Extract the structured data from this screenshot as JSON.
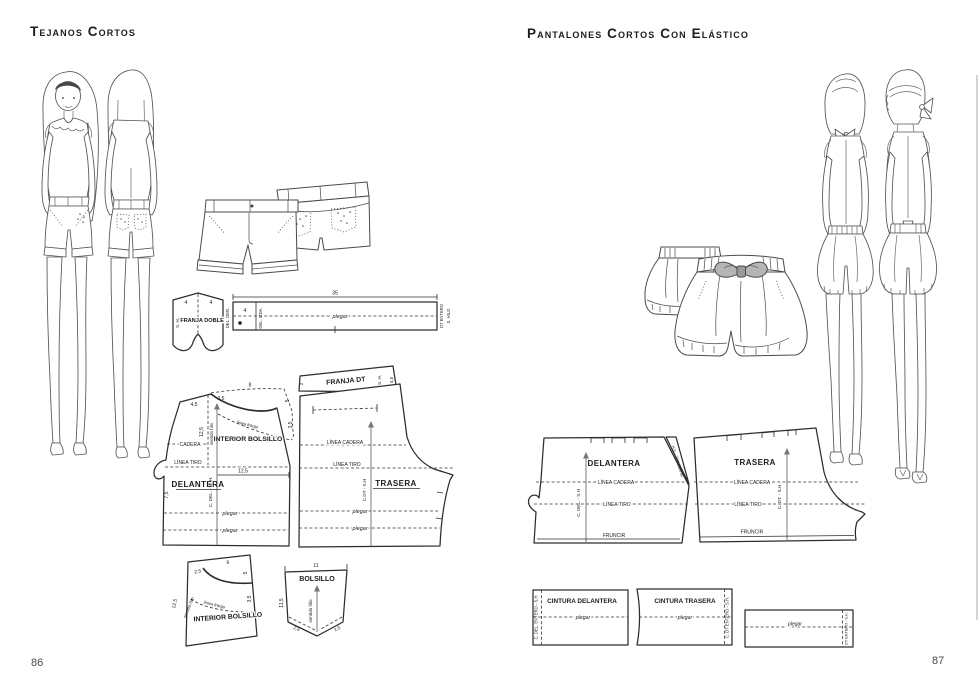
{
  "doc": {
    "left": {
      "title": "Tejanos Cortos",
      "page": "86",
      "franja_doble": {
        "label": "FRANJA DOBLE",
        "sh": "S. H.",
        "w1": "4",
        "w2": "4"
      },
      "strip": {
        "len": "35",
        "w": "4",
        "del_der": "DEL. DER.",
        "del_izda": "DEL. IZDA.",
        "plegar": "plegar",
        "dt": "DT ENTERO",
        "sh": "S. HILO"
      },
      "delantera": {
        "label": "DELANTERA",
        "m45": "4,5",
        "m25": "2,5",
        "m8": "8",
        "m5": "5",
        "m35": "3,5",
        "m125v": "12,5",
        "hilo": "sentido hilo",
        "bolsillo": "INTERIOR BOLSILLO",
        "franja": "línea franja",
        "cadera": "CADERA",
        "tiro": "LÍNEA TIRO",
        "m125": "12,5",
        "m75": "7,5",
        "grain": "C. DEL. - S. H.",
        "plegar1": "plegar",
        "plegar2": "plegar"
      },
      "trasera": {
        "banda": "FRANJA DT",
        "m2": "2",
        "sh": "S. H.",
        "m45": "4,5",
        "cadera": "LÍNEA CADERA",
        "tiro": "LÍNEA TIRO",
        "grain": "C.DT - S.H",
        "label": "TRASERA",
        "plegar1": "plegar",
        "plegar2": "plegar"
      },
      "int_bolsillo": {
        "label": "INTERIOR BOLSILLO",
        "m25": "2,5",
        "m8": "8",
        "m5": "5",
        "m35": "3,5",
        "m125": "12,5",
        "hilo": "sentido hilo",
        "franja": "línea franja"
      },
      "bolsillo": {
        "label": "BOLSILLO",
        "m11": "11",
        "m115": "11,5",
        "m25l": "2,5",
        "m25r": "2,5",
        "hilo": "sentido hilo"
      }
    },
    "right": {
      "title": "Pantalones Cortos Con Elástico",
      "page": "87",
      "delantera": {
        "label": "DELANTERA",
        "cadera": "LÍNEA CADERA",
        "tiro": "LÍNEA TIRO",
        "grain": "C. DEL. - S.H",
        "fruncir": "FRUNCIR"
      },
      "sesgo": {
        "label": "SESGO DEL. - S.H"
      },
      "trasera": {
        "label": "TRASERA",
        "cadera": "LÍNEA CADERA",
        "tiro": "LÍNEA TIRO",
        "grain": "C. DT. - S.H",
        "fruncir": "FRUNCIR"
      },
      "cint_del": {
        "label": "CINTURA DELANTERA",
        "plegar": "plegar",
        "grain": "C. DEL. ENTERO - S.H"
      },
      "cint_tras": {
        "label": "CINTURA TRASERA",
        "plegar": "plegar",
        "grain": "C. DT ENTERO - S.H."
      },
      "strip": {
        "plegar": "plegar",
        "grain": "DT ENTERO - S.H."
      }
    },
    "illustrations": {
      "left_models": "two-girls-front-and-back-view-wearing-denim-shorts",
      "left_flat": "denim-shorts-flat-front-and-back",
      "right_models": "two-girls-back-view-wearing-elastic-shorts",
      "right_flat": "elastic-shorts-with-bow-flat-front-and-back"
    }
  }
}
